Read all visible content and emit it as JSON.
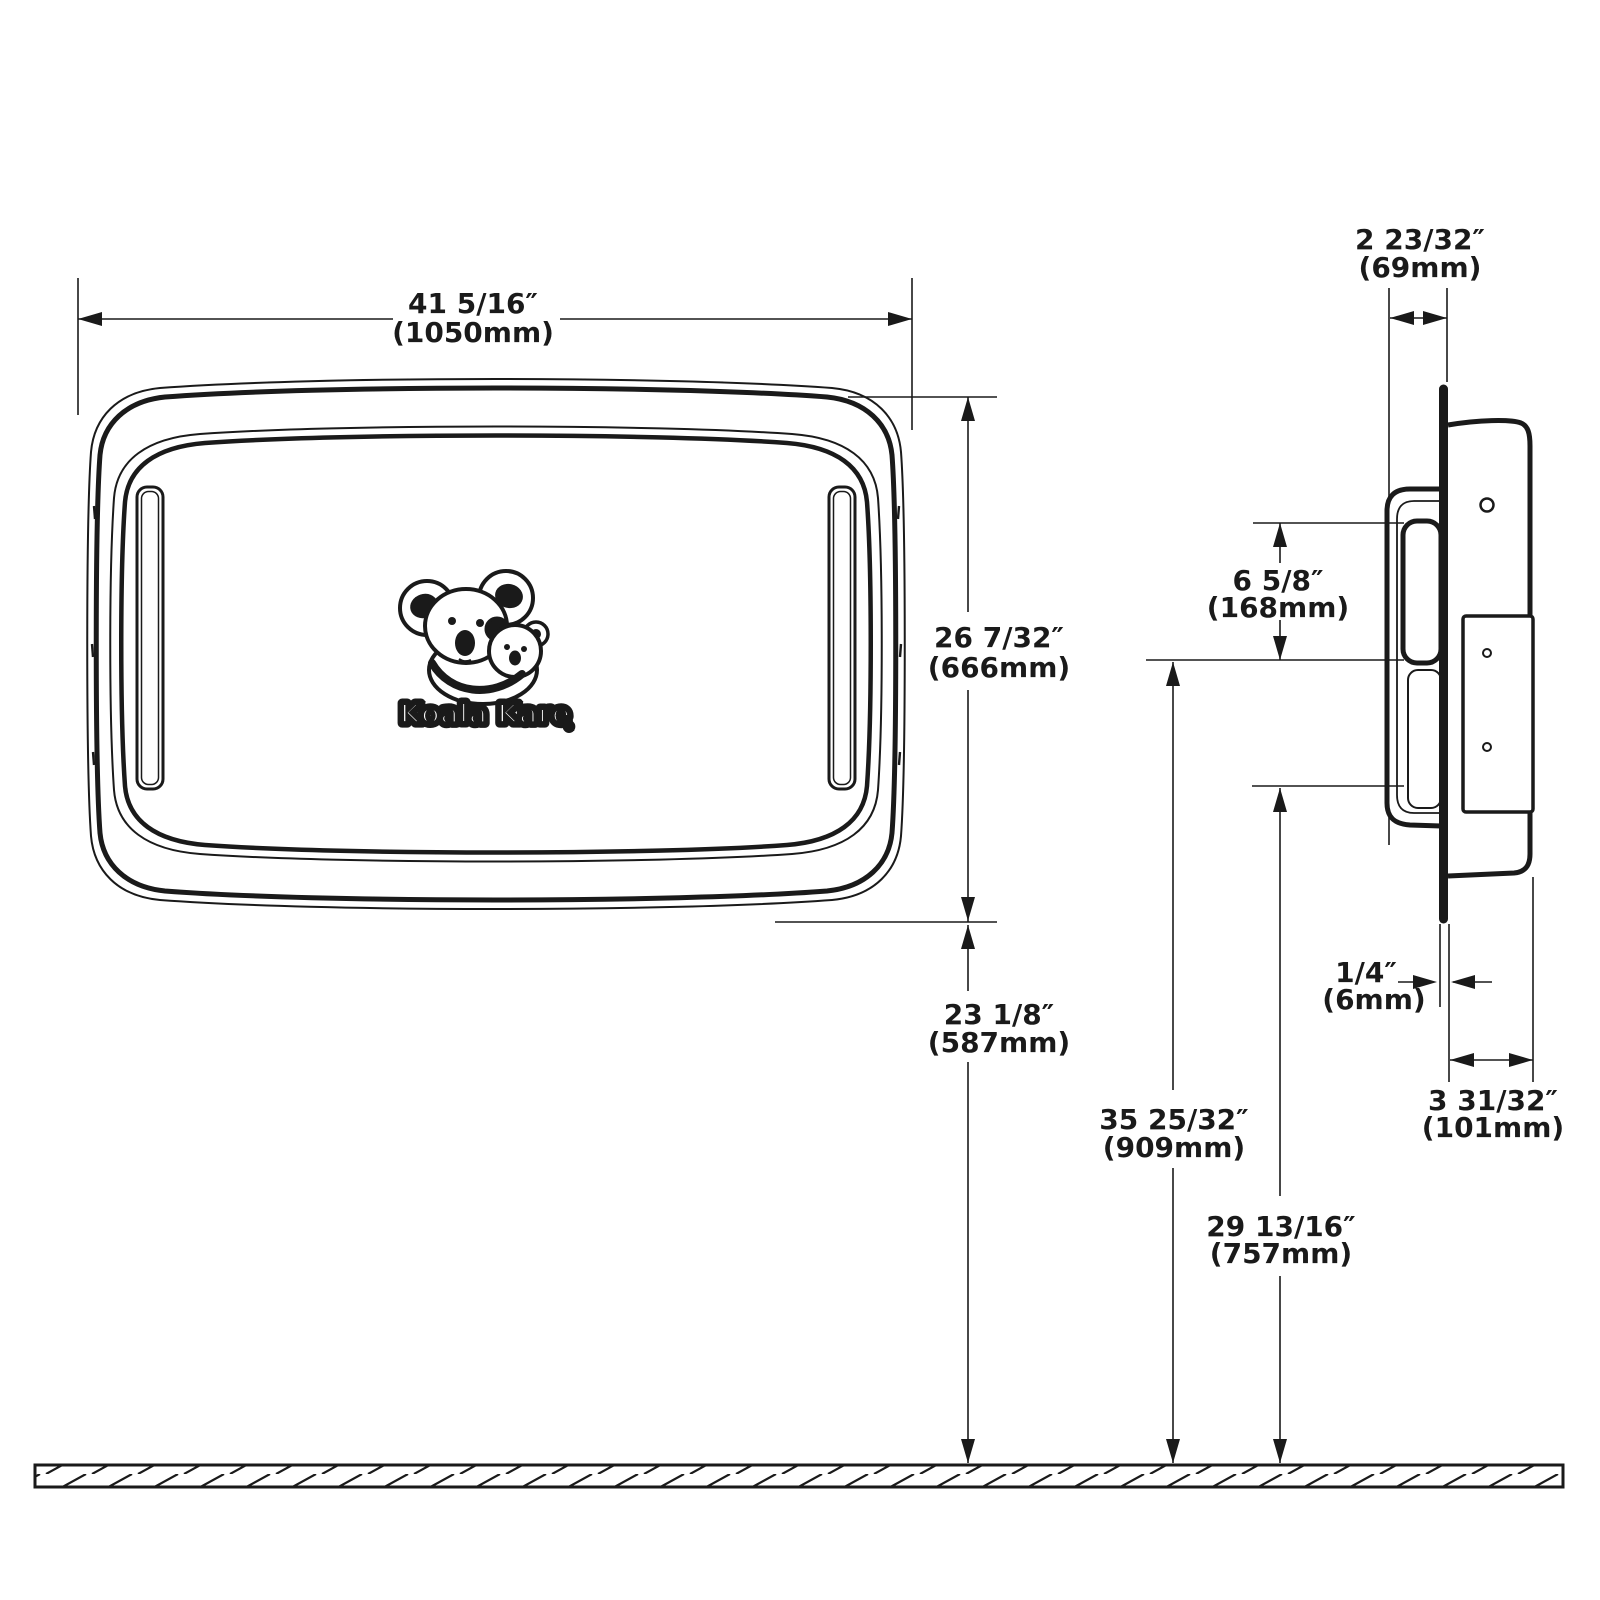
{
  "page": {
    "background": "#ffffff",
    "line_color": "#1a1a1a"
  },
  "logo": {
    "brand": "Koala Kare",
    "registered_mark": "®"
  },
  "dimensions": {
    "overall_width": {
      "inches": "41 5/16″",
      "metric": "(1050mm)"
    },
    "unit_height": {
      "inches": "26 7/32″",
      "metric": "(666mm)"
    },
    "height_to_floor": {
      "inches": "23 1/8″",
      "metric": "(587mm)"
    },
    "recess_depth": {
      "inches": "2 23/32″",
      "metric": "(69mm)"
    },
    "opening_height": {
      "inches": "6 5/8″",
      "metric": "(168mm)"
    },
    "top_mount_height": {
      "inches": "35 25/32″",
      "metric": "(909mm)"
    },
    "bottom_mount_height": {
      "inches": "29 13/16″",
      "metric": "(757mm)"
    },
    "flange_projection": {
      "inches": "1/4″",
      "metric": "(6mm)"
    },
    "body_projection": {
      "inches": "3 31/32″",
      "metric": "(101mm)"
    }
  }
}
